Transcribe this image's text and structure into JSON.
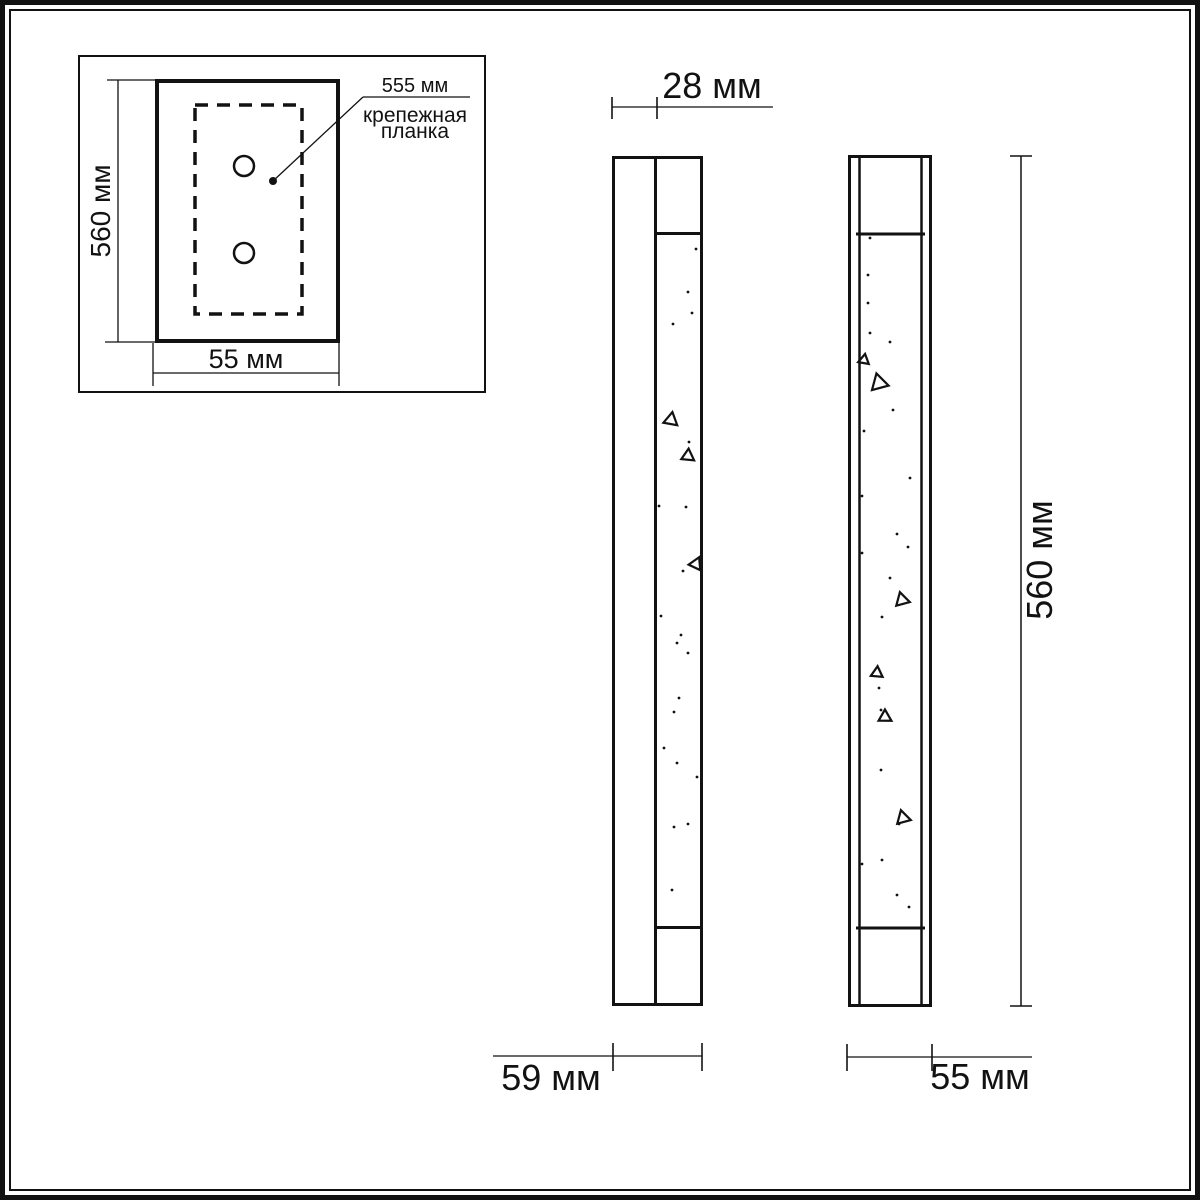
{
  "colors": {
    "ink": "#121212",
    "background": "#ffffff"
  },
  "inset": {
    "height_label": "560 мм",
    "width_label": "55 мм",
    "callout_value": "555 мм",
    "callout_label_line1": "крепежная",
    "callout_label_line2": "планка"
  },
  "side_view": {
    "depth_label": "28 мм",
    "total_depth_label": "59 мм",
    "sparkles": {
      "dots": [
        [
          696,
          249
        ],
        [
          688,
          292
        ],
        [
          692,
          313
        ],
        [
          673,
          324
        ],
        [
          689,
          442
        ],
        [
          659,
          506
        ],
        [
          686,
          507
        ],
        [
          683,
          571
        ],
        [
          661,
          616
        ],
        [
          681,
          635
        ],
        [
          677,
          643
        ],
        [
          688,
          653
        ],
        [
          679,
          698
        ],
        [
          674,
          712
        ],
        [
          664,
          748
        ],
        [
          677,
          763
        ],
        [
          697,
          777
        ],
        [
          688,
          824
        ],
        [
          674,
          827
        ],
        [
          672,
          890
        ]
      ],
      "triangles": [
        [
          671,
          420,
          13,
          10
        ],
        [
          688,
          456,
          12,
          -115
        ],
        [
          696,
          564,
          12,
          -95
        ]
      ]
    }
  },
  "front_view": {
    "height_label": "560 мм",
    "width_label": "55 мм",
    "sparkles": {
      "dots": [
        [
          870,
          238
        ],
        [
          868,
          275
        ],
        [
          868,
          303
        ],
        [
          870,
          333
        ],
        [
          890,
          342
        ],
        [
          893,
          410
        ],
        [
          864,
          431
        ],
        [
          910,
          478
        ],
        [
          862,
          496
        ],
        [
          897,
          534
        ],
        [
          908,
          547
        ],
        [
          862,
          553
        ],
        [
          890,
          578
        ],
        [
          882,
          617
        ],
        [
          879,
          688
        ],
        [
          881,
          710
        ],
        [
          881,
          770
        ],
        [
          899,
          824
        ],
        [
          882,
          860
        ],
        [
          862,
          864
        ],
        [
          897,
          895
        ],
        [
          909,
          907
        ]
      ],
      "triangles": [
        [
          864,
          360,
          10,
          -110
        ],
        [
          879,
          383,
          16,
          -15
        ],
        [
          902,
          600,
          13,
          -15
        ],
        [
          877,
          673,
          11,
          5
        ],
        [
          885,
          717,
          12,
          -120
        ],
        [
          903,
          818,
          13,
          -15
        ]
      ]
    }
  }
}
